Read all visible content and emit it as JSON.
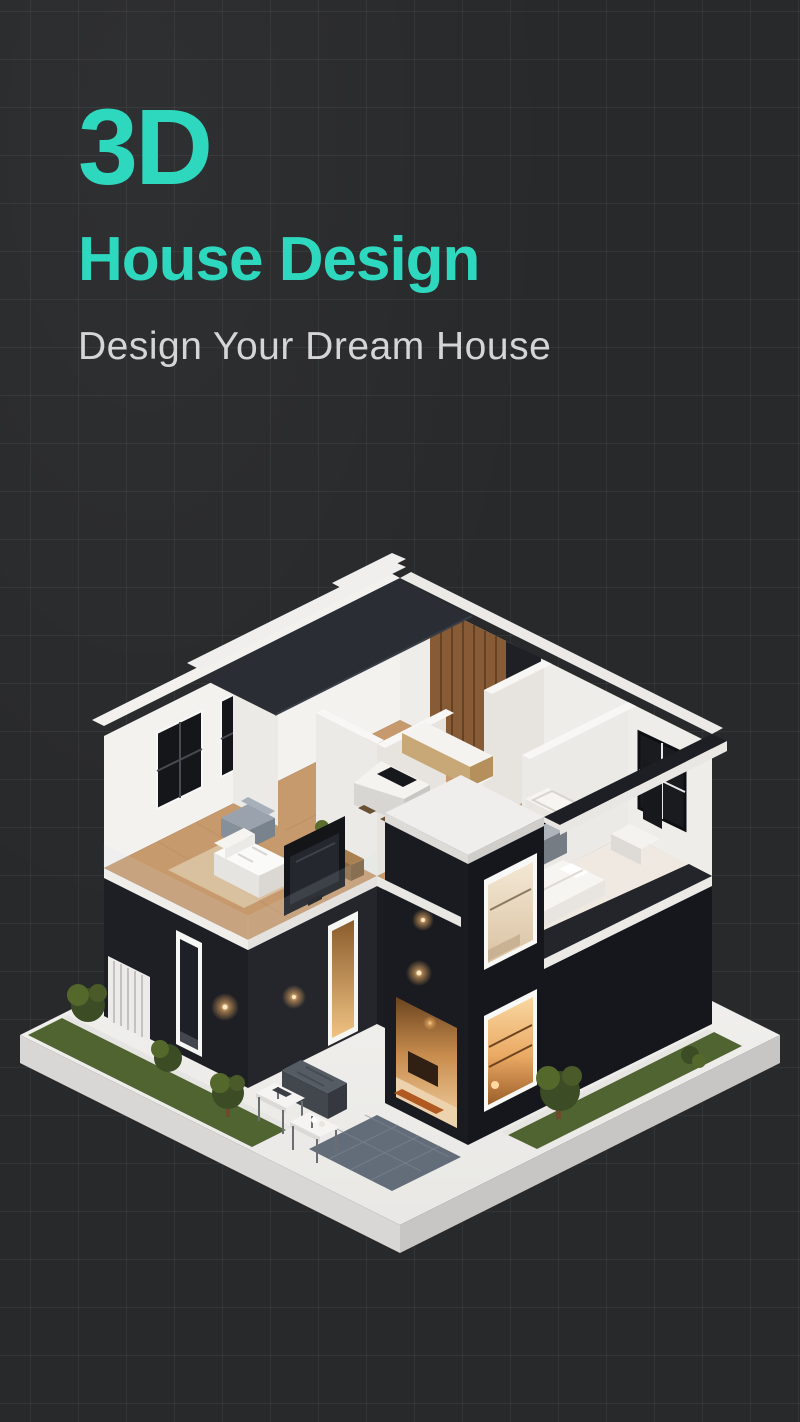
{
  "hero": {
    "title": "3D",
    "title_line2": "House Design",
    "tagline": "Design Your Dream House"
  },
  "theme": {
    "background": "#28292b",
    "grid_line": "rgba(255,255,255,0.05)",
    "accent": "#2ed8be",
    "tagline_color": "#d5d5d5"
  },
  "illustration": {
    "label": "isometric-cutaway-house-3d-render",
    "palette": {
      "platform": "#f1f0ee",
      "platform_side": "#d8d7d5",
      "wall_dark": "#1e1f24",
      "wall_darker": "#16171c",
      "wall_white": "#f4f2ef",
      "wood_floor": "#c69a6d",
      "wood_wall": "#875b36",
      "grass": "#4f6430",
      "foliage": "#45562a",
      "pavers": "#636d79",
      "roof": "#2a2d34",
      "warm_light": "#f6c489",
      "window_frame": "#101114"
    }
  }
}
